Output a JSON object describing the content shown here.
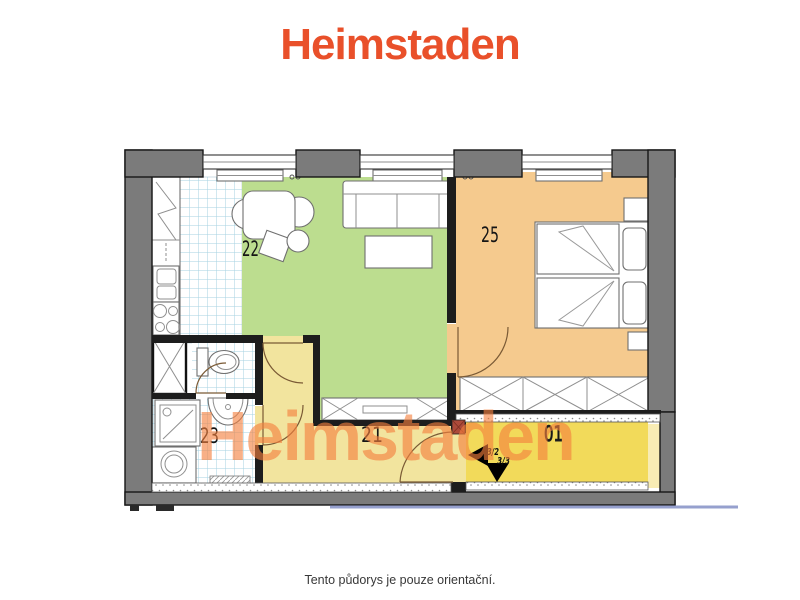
{
  "header": {
    "logo_text": "Heimstaden"
  },
  "watermark": {
    "text": "Heimstaden",
    "color": "#F5803E",
    "opacity": 0.62
  },
  "footer": {
    "disclaimer": "Tento půdorys je pouze orientační."
  },
  "floor_plan": {
    "rooms": [
      {
        "number": "22",
        "name": "kitchen-living-room",
        "fill": "#BCDD8F",
        "furniture": [
          "kitchen-counter",
          "sink",
          "stove",
          "dining-table",
          "chairs",
          "sofa",
          "coffee-table",
          "tv-sideboard",
          "radiator"
        ]
      },
      {
        "number": "25",
        "name": "bedroom",
        "fill": "#F5CA8E",
        "furniture": [
          "double-bed",
          "pillows",
          "nightstand",
          "wardrobe",
          "radiator"
        ]
      },
      {
        "number": "23",
        "name": "bathroom",
        "fill": "tile-pattern",
        "furniture": [
          "shower-cabin",
          "shower-tray",
          "washbasin",
          "washing-machine",
          "bath-mat",
          "toilet"
        ]
      },
      {
        "number": "21",
        "name": "hallway",
        "fill": "#F2E49E",
        "furniture": [
          "entrance-door"
        ]
      },
      {
        "number": "01",
        "name": "corridor",
        "fill": "#F2DA5A",
        "furniture": []
      }
    ],
    "entrance_signs": {
      "left": "3/2",
      "down": "3/3"
    },
    "colors": {
      "exterior_wall": "#7B7B7B",
      "interior_wall": "#1D1D1D",
      "tile_line": "#A5D2E2",
      "living": "#BCDD8F",
      "bedroom": "#F5CA8E",
      "hallway": "#F2E49E",
      "corridor": "#F2DA5A",
      "logo": "#E9502A",
      "watermark": "#F5803E",
      "section_line": "#96A0CE"
    },
    "windows_top": 3
  }
}
